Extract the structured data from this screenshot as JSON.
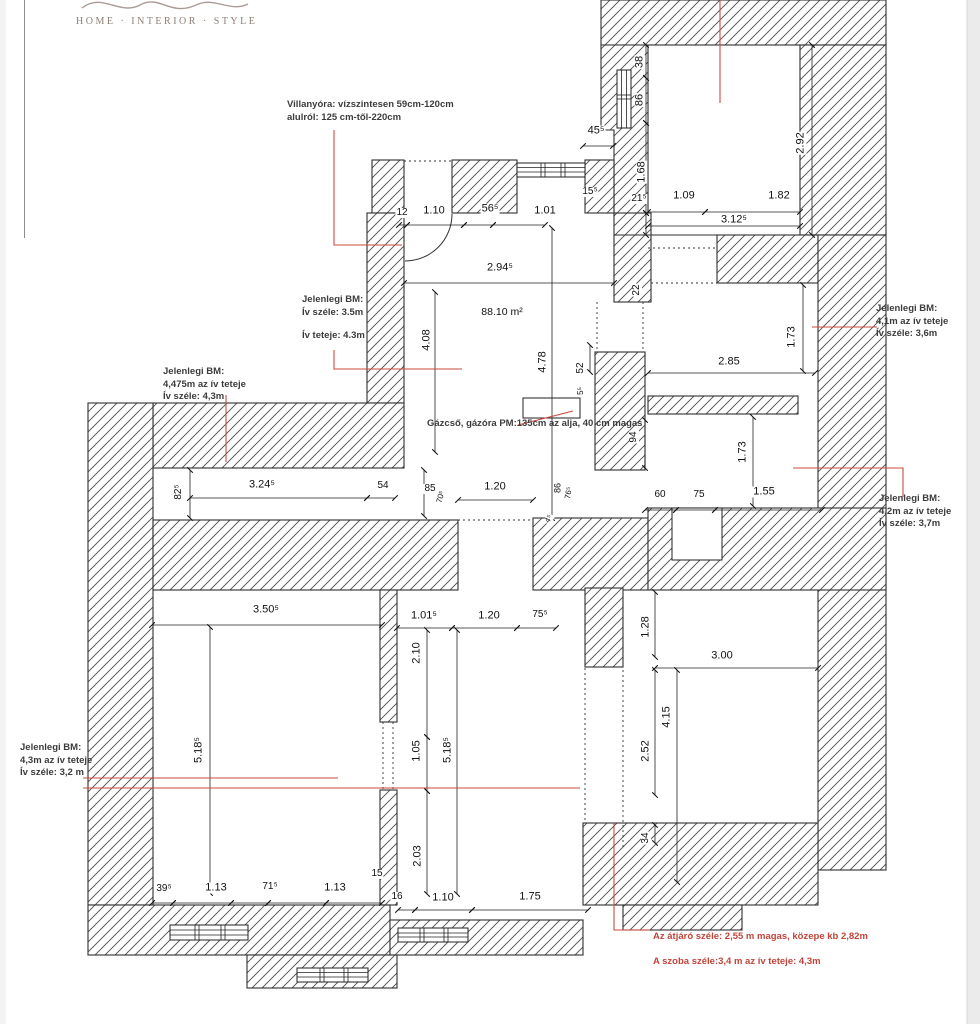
{
  "page": {
    "background": "#ffffff",
    "right_strip_color": "#ebebeb",
    "margin_line_color": "#8d8d8d"
  },
  "logo": {
    "tagline": "HOME · INTERIOR · STYLE",
    "color": "#8d7f76"
  },
  "plan": {
    "red_accent": "#cd4a3d",
    "line_color": "#2f2f2f",
    "area_label": "88.10 m²",
    "dim_labels": [
      {
        "t": "38",
        "x": 640,
        "y": 62,
        "r": -90
      },
      {
        "t": "86",
        "x": 640,
        "y": 100,
        "r": -90
      },
      {
        "t": "1.68",
        "x": 642,
        "y": 172,
        "r": -90
      },
      {
        "t": "21⁵",
        "x": 639,
        "y": 199,
        "s": 10
      },
      {
        "t": "2.92",
        "x": 801,
        "y": 143,
        "r": -90
      },
      {
        "t": "1.09",
        "x": 684,
        "y": 196
      },
      {
        "t": "1.82",
        "x": 779,
        "y": 196
      },
      {
        "t": "3.12⁵",
        "x": 734,
        "y": 220
      },
      {
        "t": "45⁵",
        "x": 596,
        "y": 131
      },
      {
        "t": "15⁵",
        "x": 590,
        "y": 192,
        "s": 10
      },
      {
        "t": "22",
        "x": 637,
        "y": 290,
        "r": -90,
        "s": 10
      },
      {
        "t": "12",
        "x": 402,
        "y": 213,
        "s": 10
      },
      {
        "t": "1.10",
        "x": 434,
        "y": 211
      },
      {
        "t": "56⁵",
        "x": 490,
        "y": 209
      },
      {
        "t": "1.01",
        "x": 545,
        "y": 211
      },
      {
        "t": "2.94⁵",
        "x": 500,
        "y": 268
      },
      {
        "t": "88.10 m²",
        "x": 502,
        "y": 312,
        "s": 10.5
      },
      {
        "t": "4.08",
        "x": 427,
        "y": 340,
        "r": -90
      },
      {
        "t": "4.78",
        "x": 543,
        "y": 362,
        "r": -90
      },
      {
        "t": "52",
        "x": 581,
        "y": 368,
        "r": -90,
        "s": 10
      },
      {
        "t": "5⁵",
        "x": 581,
        "y": 391,
        "r": -90,
        "s": 8
      },
      {
        "t": "2.85",
        "x": 729,
        "y": 362
      },
      {
        "t": "1.73",
        "x": 792,
        "y": 337,
        "r": -90
      },
      {
        "t": "82⁵",
        "x": 179,
        "y": 492,
        "r": -90,
        "s": 10
      },
      {
        "t": "3.24⁵",
        "x": 262,
        "y": 485
      },
      {
        "t": "54",
        "x": 383,
        "y": 486,
        "s": 10
      },
      {
        "t": "85",
        "x": 430,
        "y": 489,
        "s": 10
      },
      {
        "t": "70⁵",
        "x": 441,
        "y": 497,
        "r": -75,
        "s": 8
      },
      {
        "t": "1.20",
        "x": 495,
        "y": 487
      },
      {
        "t": "86",
        "x": 558,
        "y": 488,
        "r": -90,
        "s": 9
      },
      {
        "t": "76⁵",
        "x": 569,
        "y": 493,
        "r": -80,
        "s": 8
      },
      {
        "t": "4⁵",
        "x": 549,
        "y": 519,
        "r": -60,
        "s": 8
      },
      {
        "t": "94",
        "x": 634,
        "y": 437,
        "r": -90,
        "s": 10
      },
      {
        "t": "60",
        "x": 660,
        "y": 495,
        "s": 10
      },
      {
        "t": "75",
        "x": 699,
        "y": 495,
        "s": 10
      },
      {
        "t": "1.55",
        "x": 764,
        "y": 492
      },
      {
        "t": "1.73",
        "x": 743,
        "y": 452,
        "r": -90
      },
      {
        "t": "3.50⁵",
        "x": 266,
        "y": 610
      },
      {
        "t": "5.18⁵",
        "x": 199,
        "y": 750,
        "r": -90
      },
      {
        "t": "39⁵",
        "x": 164,
        "y": 889,
        "s": 10
      },
      {
        "t": "1.13",
        "x": 216,
        "y": 888
      },
      {
        "t": "71⁵",
        "x": 270,
        "y": 887,
        "s": 10
      },
      {
        "t": "1.13",
        "x": 335,
        "y": 888
      },
      {
        "t": "15",
        "x": 377,
        "y": 874,
        "s": 10
      },
      {
        "t": "16",
        "x": 397,
        "y": 897,
        "s": 10
      },
      {
        "t": "1.01⁵",
        "x": 424,
        "y": 616
      },
      {
        "t": "1.20",
        "x": 489,
        "y": 616
      },
      {
        "t": "75⁵",
        "x": 540,
        "y": 615,
        "s": 10
      },
      {
        "t": "2.10",
        "x": 417,
        "y": 653,
        "r": -90
      },
      {
        "t": "1.05",
        "x": 417,
        "y": 751,
        "r": -90
      },
      {
        "t": "5.18⁵",
        "x": 448,
        "y": 750,
        "r": -90
      },
      {
        "t": "2.03",
        "x": 418,
        "y": 856,
        "r": -90
      },
      {
        "t": "1.10",
        "x": 443,
        "y": 898
      },
      {
        "t": "1.75",
        "x": 530,
        "y": 897
      },
      {
        "t": "1.28",
        "x": 646,
        "y": 627,
        "r": -90
      },
      {
        "t": "3.00",
        "x": 722,
        "y": 656
      },
      {
        "t": "4.15",
        "x": 667,
        "y": 717,
        "r": -90
      },
      {
        "t": "2.52",
        "x": 646,
        "y": 751,
        "r": -90
      },
      {
        "t": "34",
        "x": 646,
        "y": 838,
        "r": -90,
        "s": 10
      }
    ],
    "annotations": [
      {
        "x": 287,
        "y": 99,
        "color": "black",
        "lines": [
          "Villanyóra: vízszintesen 59cm-120cm",
          "alulról: 125 cm-től-220cm"
        ]
      },
      {
        "x": 302,
        "y": 294,
        "color": "black",
        "lines": [
          "Jelenlegi BM:",
          "Ív széle: 3.5m",
          "",
          "Ív teteje: 4.3m"
        ]
      },
      {
        "x": 163,
        "y": 366,
        "color": "black",
        "lines": [
          "Jelenlegi BM:",
          "4,475m az ív teteje",
          "Ív széle: 4,3m"
        ]
      },
      {
        "x": 427,
        "y": 418,
        "color": "black",
        "lines": [
          "Gázcső, gázóra PM:135cm az alja, 40 cm magas"
        ]
      },
      {
        "x": 876,
        "y": 303,
        "color": "black",
        "lines": [
          "Jelenlegi BM:",
          "4,1m az ív teteje",
          "Ív széle: 3,6m"
        ]
      },
      {
        "x": 879,
        "y": 493,
        "color": "black",
        "lines": [
          "Jelenlegi BM:",
          "4,2m az ív teteje",
          "Ív széle: 3,7m"
        ]
      },
      {
        "x": 20,
        "y": 742,
        "color": "black",
        "lines": [
          "Jelenlegi BM:",
          "4,3m az ív teteje",
          "Ív széle: 3,2 m"
        ]
      },
      {
        "x": 653,
        "y": 931,
        "color": "red",
        "lines": [
          "Az átjáró széle: 2,55 m magas, közepe kb 2,82m"
        ]
      },
      {
        "x": 653,
        "y": 956,
        "color": "red",
        "lines": [
          "A szoba széle:3,4 m az ív teteje: 4,3m"
        ]
      }
    ]
  }
}
